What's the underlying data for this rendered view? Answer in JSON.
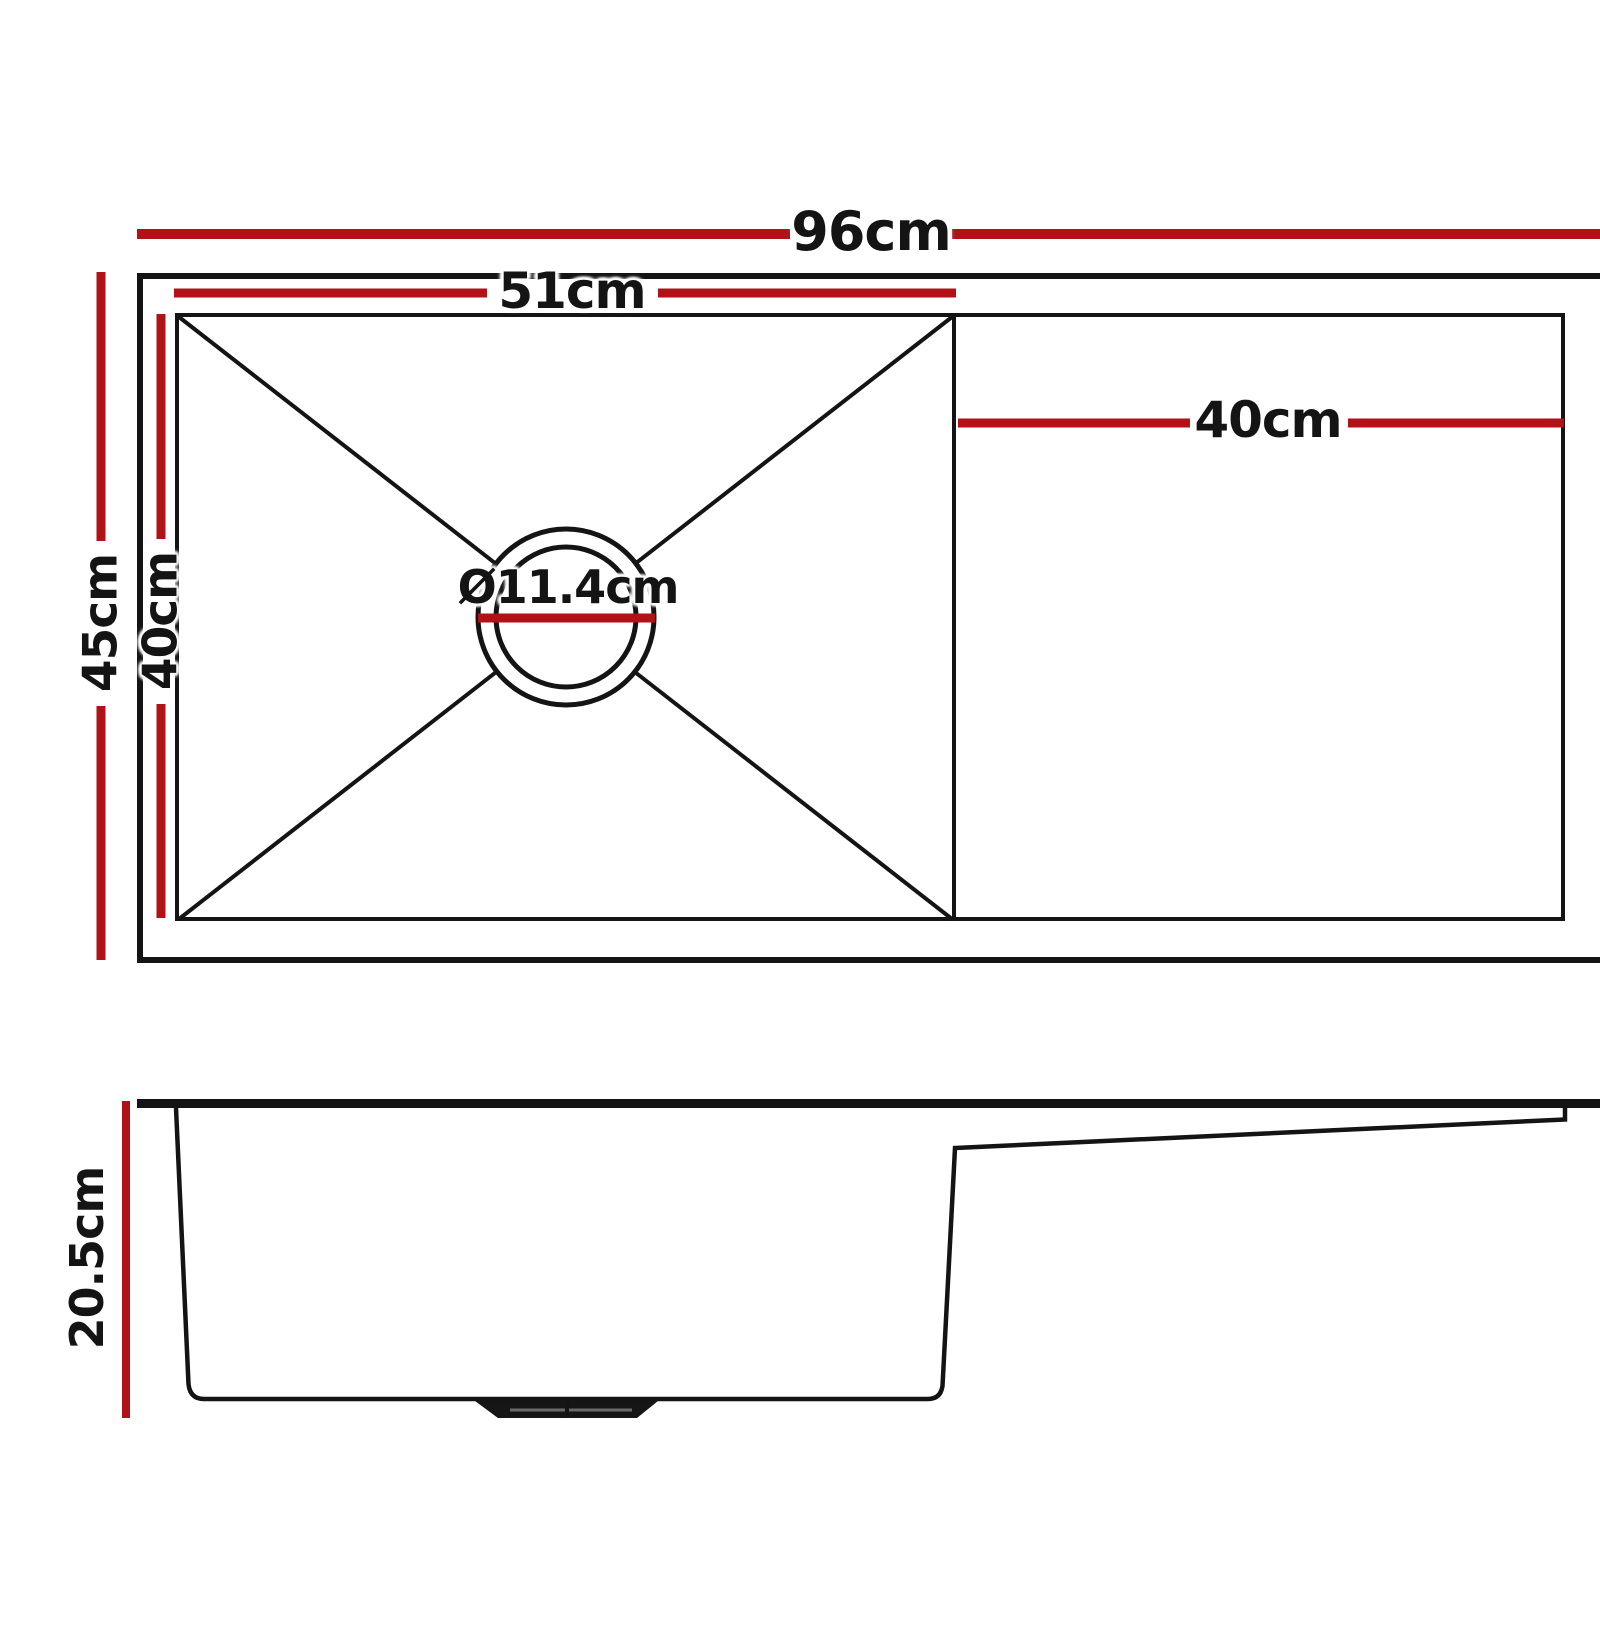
{
  "colors": {
    "dimension_red": "#b01217",
    "line_black": "#141414",
    "background": "#ffffff"
  },
  "diagram": {
    "top_view": {
      "overall_width": "96cm",
      "bowl_width": "51cm",
      "drainer_width": "40cm",
      "overall_depth": "45cm",
      "bowl_depth": "40cm",
      "drain_diameter": "Ø11.4cm"
    },
    "side_view": {
      "depth": "20.5cm"
    }
  }
}
